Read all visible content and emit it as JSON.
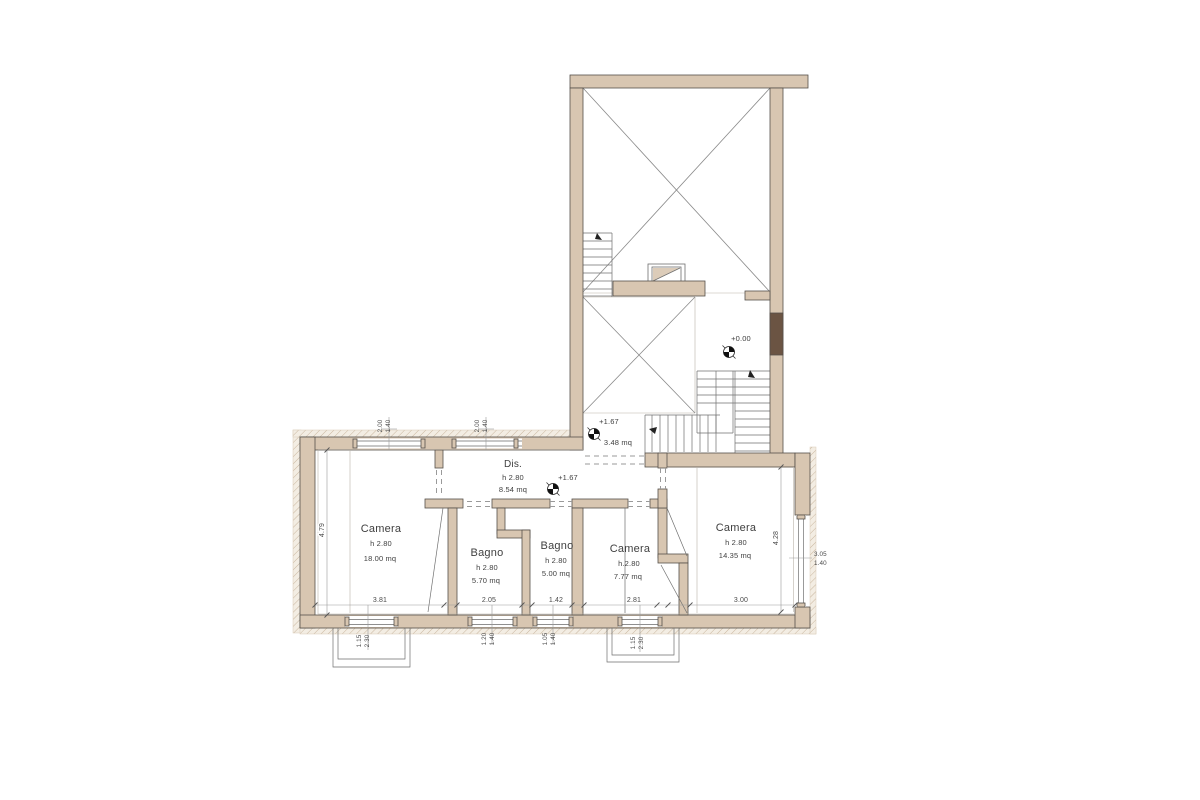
{
  "colors": {
    "wall": "#d8c6b1",
    "wall_dark": "#6b5443",
    "outline": "#55504a",
    "thin_line": "#6f6f6f",
    "dashed": "#9a9a9a",
    "hatch": "#c9b69f",
    "hatch_bg": "#f3ede3",
    "text": "#3f3f3f",
    "background": "#ffffff"
  },
  "rooms": {
    "camera_18": {
      "name": "Camera",
      "height": "h 2.80",
      "area": "18.00 mq"
    },
    "bagno_570": {
      "name": "Bagno",
      "height": "h 2.80",
      "area": "5.70 mq"
    },
    "bagno_500": {
      "name": "Bagno",
      "height": "h 2.80",
      "area": "5.00 mq"
    },
    "camera_777": {
      "name": "Camera",
      "height": "h.2.80",
      "area": "7.77 mq"
    },
    "camera_1435": {
      "name": "Camera",
      "height": "h 2.80",
      "area": "14.35 mq"
    },
    "dis": {
      "name": "Dis.",
      "height": "h 2.80",
      "area": "8.54 mq"
    },
    "landing": {
      "area": "3.48 mq"
    }
  },
  "levels": {
    "ground": "+0.00",
    "landing": "+1.67",
    "hallway": "+1.67"
  },
  "dims": {
    "camera18_width": "3.81",
    "bagno570_width": "2.05",
    "bagno500_width": "1.42",
    "camera777_width": "2.81",
    "camera1435_width": "3.00",
    "camera18_depth": "4.79",
    "camera1435_depth": "4.28",
    "win_top_1": {
      "w": "2.00",
      "h": "1.40"
    },
    "win_top_2": {
      "w": "2.00",
      "h": "1.40"
    },
    "win_bottom_1": {
      "w": "1.15",
      "h": "2.30"
    },
    "win_bottom_2": {
      "w": "1.20",
      "h": "1.40"
    },
    "win_bottom_3": {
      "w": "1.05",
      "h": "1.40"
    },
    "win_bottom_4": {
      "w": "1.15",
      "h": "2.30"
    },
    "win_right": {
      "w": "3.05",
      "h": "1.40"
    }
  }
}
